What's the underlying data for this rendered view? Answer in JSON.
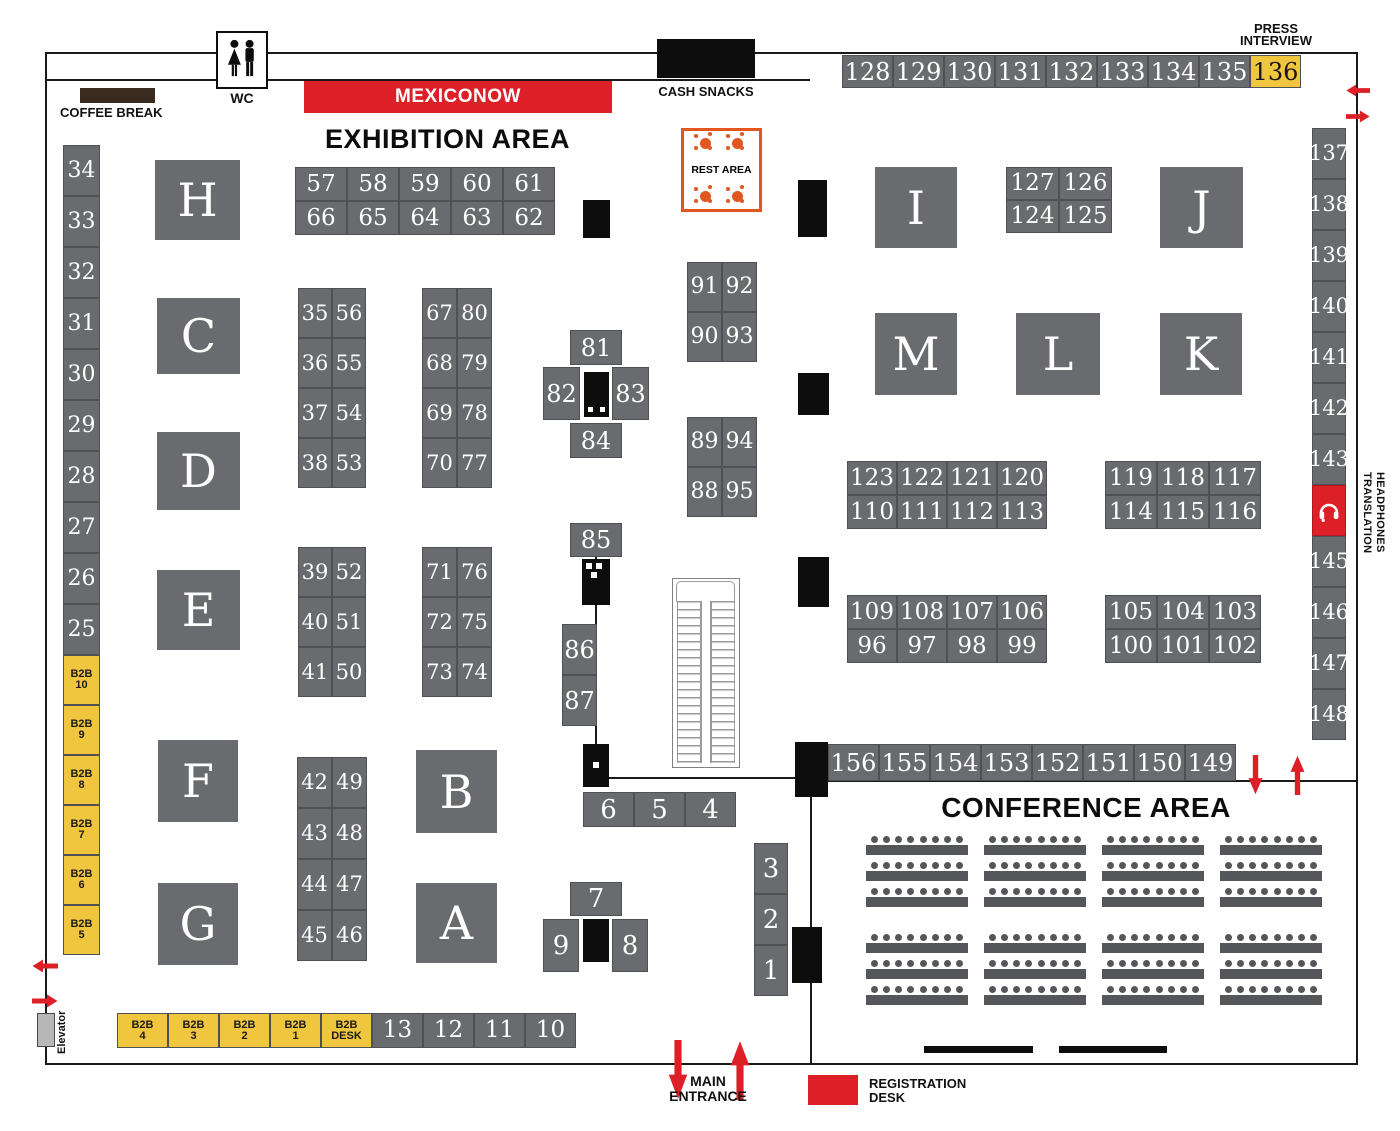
{
  "labels": {
    "exhibition_title": "EXHIBITION AREA",
    "conference_title": "CONFERENCE AREA",
    "mexiconow": "MEXICONOW",
    "cash_snacks": "CASH SNACKS",
    "coffee_break": "COFFEE BREAK",
    "wc": "WC",
    "rest_area": "REST AREA",
    "press_line1": "PRESS",
    "press_line2": "INTERVIEW",
    "translation_line1": "TRANSLATION",
    "translation_line2": "HEADPHONES",
    "main_entrance_line1": "MAIN",
    "main_entrance_line2": "ENTRANCE",
    "registration_line1": "REGISTRATION",
    "registration_line2": "DESK",
    "elevator": "Elevator"
  },
  "letter_booths": [
    "H",
    "C",
    "D",
    "E",
    "F",
    "G",
    "B",
    "A",
    "I",
    "J",
    "M",
    "L",
    "K"
  ],
  "booths": {
    "grid_57_66": [
      "57",
      "58",
      "59",
      "60",
      "61",
      "66",
      "65",
      "64",
      "63",
      "62"
    ],
    "grid_35_53": [
      "35",
      "56",
      "36",
      "55",
      "37",
      "54",
      "38",
      "53"
    ],
    "grid_39_50": [
      "39",
      "52",
      "40",
      "51",
      "41",
      "50"
    ],
    "grid_42_46": [
      "42",
      "49",
      "43",
      "48",
      "44",
      "47",
      "45",
      "46"
    ],
    "grid_67_77": [
      "67",
      "80",
      "68",
      "79",
      "69",
      "78",
      "70",
      "77"
    ],
    "grid_71_74": [
      "71",
      "76",
      "72",
      "75",
      "73",
      "74"
    ],
    "grid_91_93": [
      "91",
      "92",
      "90",
      "93"
    ],
    "grid_89_95": [
      "89",
      "94",
      "88",
      "95"
    ],
    "grid_127_125": [
      "127",
      "126",
      "124",
      "125"
    ],
    "grid_123_113": [
      "123",
      "122",
      "121",
      "120",
      "110",
      "111",
      "112",
      "113"
    ],
    "grid_119_116": [
      "119",
      "118",
      "117",
      "114",
      "115",
      "116"
    ],
    "grid_109_99": [
      "109",
      "108",
      "107",
      "106",
      "96",
      "97",
      "98",
      "99"
    ],
    "grid_105_102": [
      "105",
      "104",
      "103",
      "100",
      "101",
      "102"
    ],
    "row_128_135": [
      "128",
      "129",
      "130",
      "131",
      "132",
      "133",
      "134",
      "135"
    ],
    "booth_136": "136",
    "row_156_149": [
      "156",
      "155",
      "154",
      "153",
      "152",
      "151",
      "150",
      "149"
    ],
    "col_137_143": [
      "137",
      "138",
      "139",
      "140",
      "141",
      "142",
      "143"
    ],
    "col_145_148": [
      "145",
      "146",
      "147",
      "148"
    ],
    "left_col_numbers": [
      "34",
      "33",
      "32",
      "31",
      "30",
      "29",
      "28",
      "27",
      "26",
      "25"
    ],
    "left_col_b2b": [
      "B2B|10",
      "B2B|9",
      "B2B|8",
      "B2B|7",
      "B2B|6",
      "B2B|5"
    ],
    "b2b_row": [
      "B2B|4",
      "B2B|3",
      "B2B|2",
      "B2B|1",
      "B2B|DESK"
    ],
    "row_13_10": [
      "13",
      "12",
      "11",
      "10"
    ],
    "row_6_4": [
      "6",
      "5",
      "4"
    ],
    "col_3_1": [
      "3",
      "2",
      "1"
    ],
    "b81": "81",
    "b82": "82",
    "b83": "83",
    "b84": "84",
    "b85": "85",
    "b86": "86",
    "b87": "87",
    "b7": "7",
    "b9": "9",
    "b8": "8"
  },
  "conference": {
    "seating": {
      "columns": 4,
      "row_groups": 2,
      "rows_per_group": 3,
      "seats_per_row": 8
    }
  },
  "icons": {
    "translation_booth": "headphones-icon",
    "wc_sign": "restroom-man-woman-icon",
    "rest_area_tables": "table-with-chairs-icon"
  },
  "colors": {
    "gray": "#6a6b6e",
    "cell-line": "#4f5055",
    "yellow": "#f1c63f",
    "red": "#dd2028",
    "orange": "#e2571f",
    "brown": "#3a2b20",
    "pillar": "#0d0d0d",
    "seat": "#55565a"
  }
}
